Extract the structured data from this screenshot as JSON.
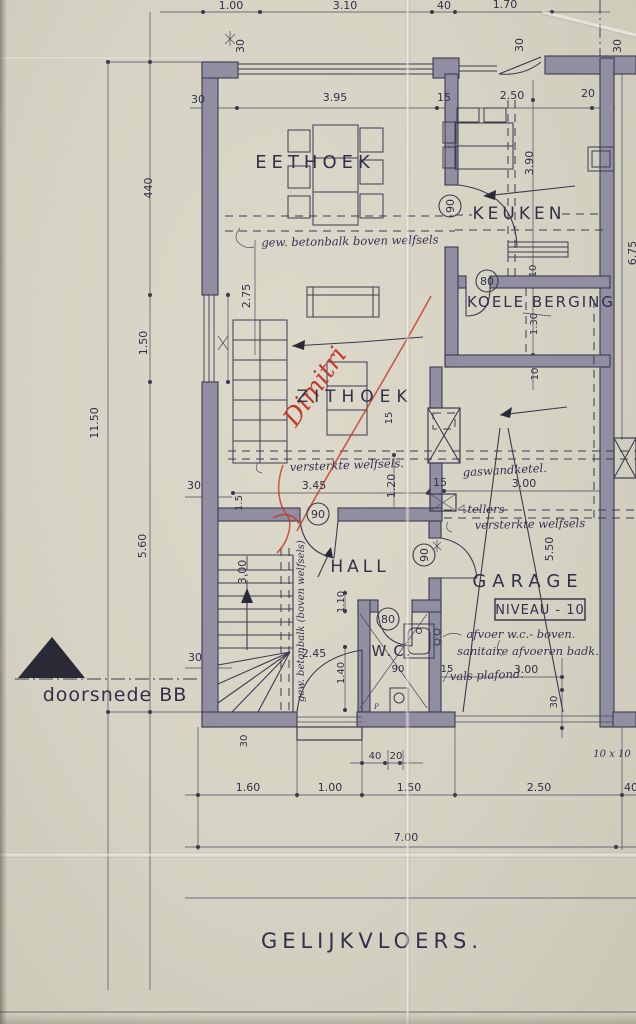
{
  "colors": {
    "paper": "#d7d3c5",
    "ink": "#3b3a50",
    "wall": "#918ea1",
    "red": "#c23b2e"
  },
  "title": "GELIJKVLOERS.",
  "section_label": "doorsnede BB",
  "rooms": {
    "eethoek": "EETHOEK",
    "keuken": "KEUKEN",
    "koele_berging": "KOELE BERGING",
    "zithoek": "ZITHOEK",
    "hall": "HALL",
    "garage": "GARAGE",
    "wc": "W.C.",
    "niveau_badge": "NIVEAU - 10"
  },
  "door_widths": {
    "keuken": "90",
    "berging": "80",
    "hall": "90",
    "garage": "90",
    "wc": "80"
  },
  "handwritten": {
    "beam_top": "gew. betonbalk boven welfsels",
    "beam_stairs": "gew. betonbalk (boven welfsels)",
    "versterkte_1": "versterkte welfsels.",
    "versterkte_2": "versterkte welfsels",
    "gaswandketel": "gaswandketel.",
    "tellers": "tellers",
    "afvoer_wc": "afvoer w.c.- boven.",
    "sanitaire": "sanitaire afvoeren badk.",
    "vals_plafond": "vals plafond.",
    "tien_x_tien": "10 x 10",
    "p_mark": "P",
    "red_note": "Dimitri"
  },
  "dims": {
    "top": [
      "1.00",
      "3.10",
      "40",
      "1.70"
    ],
    "row2": [
      "30",
      "3.95",
      "15",
      "2.50",
      "20"
    ],
    "top_30_star": "30",
    "top_30_b": "30",
    "top_30_c": "30",
    "keuken_h": "3.90",
    "right_h": "6.75",
    "left_440": "440",
    "left_275": "2.75",
    "left_150": "1.50",
    "left_1150": "11.50",
    "left_560": "5.60",
    "stair_300": "3.00",
    "stair_15": "1.5",
    "left_30_a": "30",
    "left_30_b": "30",
    "zit_345": "3.45",
    "zit_120": "1.20",
    "zit_15": "15",
    "berg_10_a": "10",
    "berg_130": "1.30",
    "berg_10_b": "10",
    "gar_15": "15",
    "gar_300": "3.00",
    "gar_550": "5.50",
    "hall_110": "1.10",
    "hall_245": "2.45",
    "hall_140": "1.40",
    "wc_90": "90",
    "wc_15": "15",
    "wc_300": "3.00",
    "wc_30": "30",
    "bot_30": "30",
    "bot_40": "40",
    "bot_20": "20",
    "bottom": [
      "1.60",
      "1.00",
      "1.50",
      "2.50",
      "40"
    ],
    "total": "7.00"
  }
}
